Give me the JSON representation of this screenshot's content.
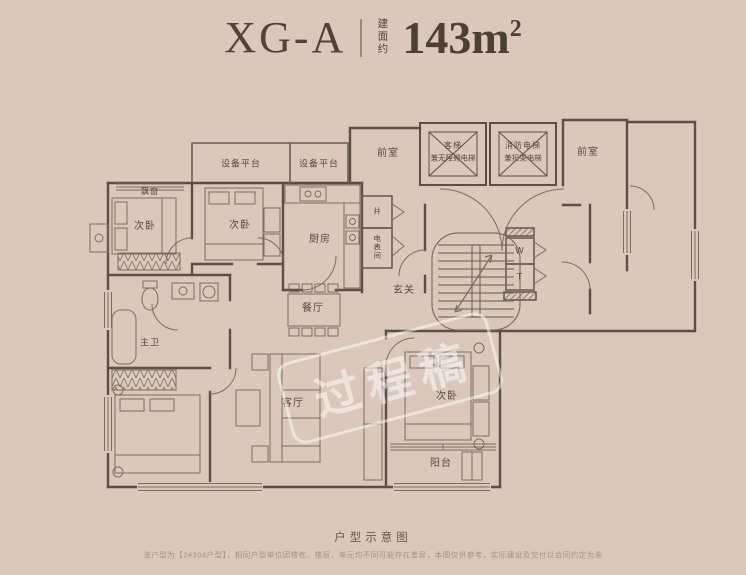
{
  "header": {
    "unit_name": "XG-A",
    "area_prefix": "建面约",
    "area_value": "143m",
    "area_sup": "2"
  },
  "plan": {
    "labels": {
      "equipment_platform_1": "设备平台",
      "equipment_platform_2": "设备平台",
      "bay_window": "飘窗",
      "bedroom_top_left": "次卧",
      "bedroom_top_mid": "次卧",
      "kitchen": "厨房",
      "shaft_small": "井",
      "meter_room": "电表间",
      "front_room_left": "前室",
      "front_room_right": "前室",
      "elevator_passenger_1": "客梯",
      "elevator_passenger_2": "兼无障碍电梯",
      "elevator_fire_1": "消防电梯",
      "elevator_fire_2": "兼担架电梯",
      "shaft_w": "W",
      "shaft_t": "T",
      "foyer": "玄关",
      "dining": "餐厅",
      "master_bath": "主卫",
      "living": "客厅",
      "bedroom_bottom": "次卧",
      "balcony": "阳台"
    },
    "watermark": "过程稿"
  },
  "footer": {
    "caption": "户型示意图",
    "disclaimer": "该户型为【2#304户型】，相同户型单位因楼栋、楼层、单元均不同可能存在差异，本图仅供参考，实际建设及交付以合同约定为准"
  },
  "colors": {
    "background": "#d9c8bb",
    "wall_line": "#5b5045",
    "thin_line": "#7b6e61",
    "title_text": "#50443a",
    "watermark": "rgba(255,255,255,0.5)"
  }
}
